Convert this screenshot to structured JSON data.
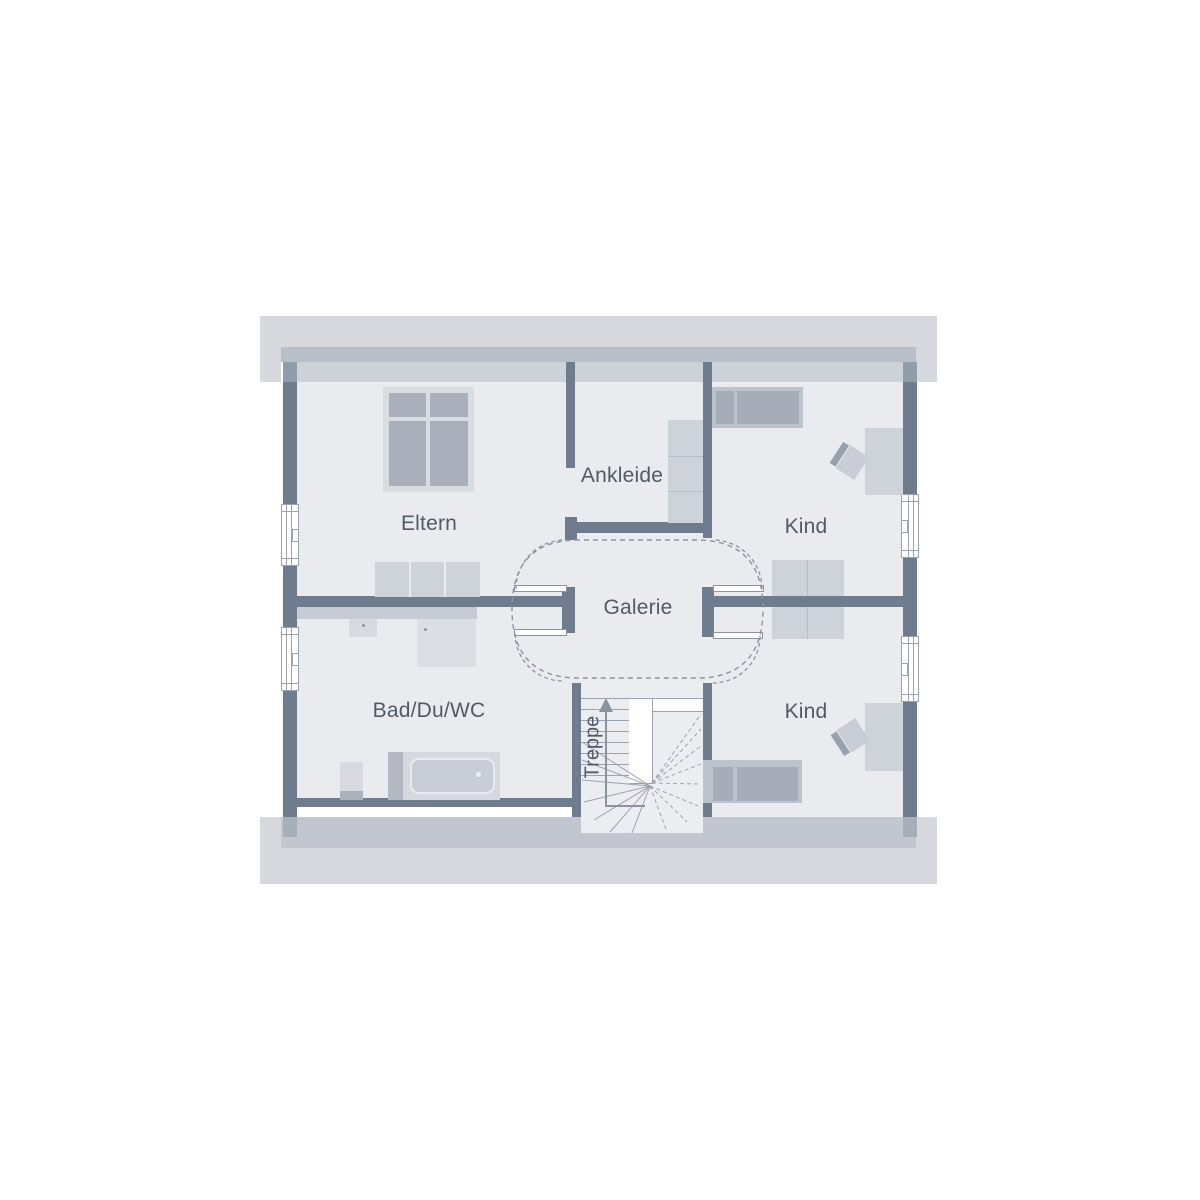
{
  "floorplan": {
    "rooms": {
      "eltern": {
        "label": "Eltern"
      },
      "ankleide": {
        "label": "Ankleide"
      },
      "kind_top": {
        "label": "Kind"
      },
      "galerie": {
        "label": "Galerie"
      },
      "bad": {
        "label": "Bad/Du/WC"
      },
      "kind_bottom": {
        "label": "Kind"
      },
      "treppe": {
        "label": "Treppe"
      }
    },
    "stairs": {
      "direction_arrow": "up"
    },
    "counts": {
      "windows": 4,
      "doors_with_swing": 4
    },
    "colors": {
      "wall": "#6e7c8d",
      "floor": "#e9ebef",
      "roof_overhang": "#d7d9de",
      "eave_band_top": "#b9bfc9",
      "eave_band_bottom": "#c2c7cf",
      "furniture_light": "#ced2d9",
      "furniture_dark": "#a6adb8",
      "line": "#9aa3af",
      "dashed_line": "#8c94a1",
      "text": "#505b68"
    }
  }
}
